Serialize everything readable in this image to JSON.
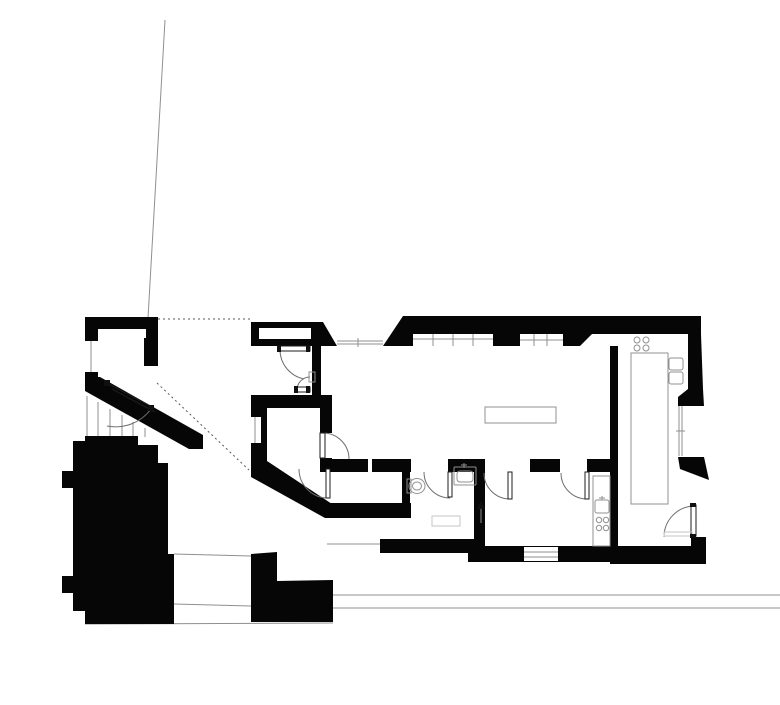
{
  "meta": {
    "document_type": "architectural-floor-plan",
    "drawing_style": "black-poche-plan",
    "title": "floor-plan"
  },
  "colors": {
    "background": "#ffffff",
    "wall": "#060606",
    "thin_line": "#8f8f8f",
    "dashed_line": "#5a5a5a",
    "arc_line": "#6e6e6e",
    "fixture_line": "#909090",
    "light_line": "#c6c6c6",
    "leaf_stroke": "#1c1c1c",
    "mark_fill": "#101010"
  },
  "canvas": {
    "width": 780,
    "height": 673
  },
  "plan": {
    "base_lines": [
      {
        "name": "site-boundary-line",
        "x1": 125,
        "y1": 4,
        "x2": 108,
        "y2": 302,
        "dash": false
      },
      {
        "name": "setback-dotted-line-top",
        "x1": 118,
        "y1": 303,
        "x2": 211,
        "y2": 303,
        "dash": true
      },
      {
        "name": "sightline-dotted-diagonal",
        "x1": 117,
        "y1": 367,
        "x2": 209,
        "y2": 454,
        "dash": true
      },
      {
        "name": "courtyard-line-top",
        "x1": 134,
        "y1": 538,
        "x2": 211,
        "y2": 540,
        "dash": false
      },
      {
        "name": "courtyard-line-mid",
        "x1": 134,
        "y1": 588,
        "x2": 211,
        "y2": 590,
        "dash": false
      },
      {
        "name": "site-bottom-line",
        "x1": 45,
        "y1": 608,
        "x2": 293,
        "y2": 607,
        "dash": false
      },
      {
        "name": "street-line-upper",
        "x1": 293,
        "y1": 579,
        "x2": 780,
        "y2": 579,
        "dash": false
      },
      {
        "name": "street-line-lower",
        "x1": 293,
        "y1": 592,
        "x2": 780,
        "y2": 592,
        "dash": false
      },
      {
        "name": "courtyard-edge-vertical",
        "x1": 117,
        "y1": 430,
        "x2": 117,
        "y2": 538,
        "dash": false
      },
      {
        "name": "stair-tread-1",
        "x1": 47,
        "y1": 380,
        "x2": 47,
        "y2": 420,
        "dash": false
      },
      {
        "name": "stair-tread-2",
        "x1": 58,
        "y1": 386,
        "x2": 58,
        "y2": 420,
        "dash": false
      },
      {
        "name": "stair-tread-3",
        "x1": 70,
        "y1": 393,
        "x2": 70,
        "y2": 420,
        "dash": false
      },
      {
        "name": "stair-tread-4",
        "x1": 82,
        "y1": 399,
        "x2": 82,
        "y2": 420,
        "dash": false
      },
      {
        "name": "stair-tread-5",
        "x1": 93,
        "y1": 406,
        "x2": 93,
        "y2": 420,
        "dash": false
      },
      {
        "name": "stair-tread-6",
        "x1": 105,
        "y1": 412,
        "x2": 105,
        "y2": 421,
        "dash": false
      }
    ],
    "wall_paths": [
      {
        "name": "entry-room-walls",
        "d": "M45,301 H118 V350 H104 V313 H58 V370 H45 Z"
      },
      {
        "name": "entry-diagonal-wall",
        "d": "M45,361 L60,361 L163,419 L163,433 L149,433 L45,375 Z"
      },
      {
        "name": "top-wall-left",
        "d": "M211,306 L283,306 L297,330 L211,330 Z"
      },
      {
        "name": "top-wall-mid-trapezoid",
        "d": "M363,300 H480 V330 H343 Z"
      },
      {
        "name": "top-wall-right",
        "d": "M480,300 H661 V318 H480 Z"
      },
      {
        "name": "top-wall-slant-piece",
        "d": "M523,318 H552 L540,330 H523 Z"
      },
      {
        "name": "right-wall-upper",
        "d": "M648,318 H661 L663,373 H648 Z"
      },
      {
        "name": "right-wall-bump",
        "d": "M648,373 H663 L664,390 H638 V381 Z"
      },
      {
        "name": "right-wall-pier",
        "d": "M638,441 L664,441 L669,464 L640,453 Z"
      },
      {
        "name": "kitchen-bottom-corner-wall",
        "d": "M570,530 H651 V521 H666 V548 H570 Z"
      },
      {
        "name": "bottom-wall-right-room",
        "d": "M428,530 H570 V546 H428 Z"
      },
      {
        "name": "right-room-west-column",
        "d": "M434,443 H445 V532 H434 Z"
      },
      {
        "name": "hall-band-seg-a",
        "d": "M280,443 H328 V456 H280 Z"
      },
      {
        "name": "hall-band-seg-b",
        "d": "M332,443 H371 V456 H332 Z"
      },
      {
        "name": "hall-band-seg-c",
        "d": "M408,443 H434 V456 H408 Z"
      },
      {
        "name": "hall-band-seg-d",
        "d": "M490,443 H520 V456 H490 Z"
      },
      {
        "name": "hall-band-seg-e",
        "d": "M547,443 H578 V456 H547 Z"
      },
      {
        "name": "vestibule-right-column",
        "d": "M272,330 H281 V392 H272 Z"
      },
      {
        "name": "vestibule-bottom-band",
        "d": "M211,379 H292 V392 H211 Z"
      },
      {
        "name": "bedroom-left-column",
        "d": "M211,392 H227 V449 H211 Z"
      },
      {
        "name": "bedroom-right-column-upper",
        "d": "M280,392 H292 V417 H280 Z"
      },
      {
        "name": "bedroom-right-column-lower",
        "d": "M280,442 H292 V456 H280 Z"
      },
      {
        "name": "bedroom-diagonal-wall",
        "d": "M211,445 L227,445 L292,488 L292,502 L285,502 L211,461 Z"
      },
      {
        "name": "storage-bottom-band",
        "d": "M285,487 H371 V502 H285 Z"
      },
      {
        "name": "bottom-band-mid",
        "d": "M340,523 H437 V537 H340 Z"
      },
      {
        "name": "wc-west-column",
        "d": "M362,455 H370 V488 H362 Z"
      },
      {
        "name": "kitchen-west-column",
        "d": "M570,330 H578 V548 H570 Z"
      },
      {
        "name": "existing-building-mass",
        "d": "M45,420 H98 V429 H118 V447 H128 V538 H134 V608 H45 V595 H33 V577 H22 V560 H33 V472 H22 V455 H33 V425 H45 Z"
      },
      {
        "name": "neighbor-building-mass",
        "d": "M211,538 L237,536 V565 L293,564 V606 H211 Z"
      }
    ],
    "white_openings": [
      {
        "name": "entry-wall-notch",
        "x": 99,
        "y": 313,
        "w": 7,
        "h": 9
      },
      {
        "name": "entry-left-window",
        "x": 45,
        "y": 325,
        "w": 13,
        "h": 31
      },
      {
        "name": "top-wall-window",
        "x": 219,
        "y": 312,
        "w": 52,
        "h": 11
      },
      {
        "name": "clerestory-window-band",
        "x": 373,
        "y": 318,
        "w": 80,
        "h": 12
      },
      {
        "name": "bedroom-west-window",
        "x": 211,
        "y": 401,
        "w": 10,
        "h": 26
      },
      {
        "name": "south-window",
        "x": 484,
        "y": 531,
        "w": 34,
        "h": 14
      }
    ],
    "detail_lines": [
      {
        "name": "window-glazing-left",
        "x1": 297,
        "y1": 325,
        "x2": 343,
        "y2": 325,
        "dash": false
      },
      {
        "name": "window-glazing-left-2",
        "x1": 297,
        "y1": 328,
        "x2": 343,
        "y2": 328,
        "dash": false
      },
      {
        "name": "window-mullion-tick",
        "x1": 318,
        "y1": 322,
        "x2": 318,
        "y2": 331,
        "dash": false
      },
      {
        "name": "clerestory-mullion-1",
        "x1": 393,
        "y1": 318,
        "x2": 393,
        "y2": 330,
        "dash": false
      },
      {
        "name": "clerestory-mullion-2",
        "x1": 413,
        "y1": 318,
        "x2": 413,
        "y2": 330,
        "dash": false
      },
      {
        "name": "clerestory-mullion-3",
        "x1": 433,
        "y1": 318,
        "x2": 433,
        "y2": 330,
        "dash": false
      },
      {
        "name": "clerestory-glazing",
        "x1": 373,
        "y1": 323,
        "x2": 453,
        "y2": 323,
        "dash": false
      },
      {
        "name": "band2-mullion-1",
        "x1": 494,
        "y1": 318,
        "x2": 494,
        "y2": 330,
        "dash": false
      },
      {
        "name": "band2-mullion-2",
        "x1": 507,
        "y1": 318,
        "x2": 507,
        "y2": 330,
        "dash": false
      },
      {
        "name": "band2-glazing",
        "x1": 480,
        "y1": 324,
        "x2": 523,
        "y2": 324,
        "dash": false
      },
      {
        "name": "entry-window-glazing",
        "x1": 51,
        "y1": 325,
        "x2": 51,
        "y2": 356,
        "dash": false
      },
      {
        "name": "bedroom-window-glazing",
        "x1": 215,
        "y1": 401,
        "x2": 215,
        "y2": 427,
        "dash": false
      },
      {
        "name": "kitchen-window-glazing-1",
        "x1": 639,
        "y1": 390,
        "x2": 639,
        "y2": 440,
        "dash": false
      },
      {
        "name": "kitchen-window-glazing-2",
        "x1": 642,
        "y1": 390,
        "x2": 642,
        "y2": 440,
        "dash": false
      },
      {
        "name": "kitchen-window-tick",
        "x1": 636,
        "y1": 415,
        "x2": 645,
        "y2": 415,
        "dash": false
      },
      {
        "name": "south-window-glazing-1",
        "x1": 484,
        "y1": 536,
        "x2": 518,
        "y2": 536,
        "dash": false
      },
      {
        "name": "south-window-glazing-2",
        "x1": 484,
        "y1": 541,
        "x2": 518,
        "y2": 541,
        "dash": false
      },
      {
        "name": "storage-floor-line",
        "x1": 287,
        "y1": 528,
        "x2": 340,
        "y2": 528,
        "dash": false
      },
      {
        "name": "wc-door-arrow-line",
        "x1": 441,
        "y1": 507,
        "x2": 441,
        "y2": 488,
        "dash": false
      },
      {
        "name": "wc-sink-faucet-v",
        "x1": 424,
        "y1": 447,
        "x2": 424,
        "y2": 452,
        "dash": false
      },
      {
        "name": "wc-sink-faucet-h",
        "x1": 421,
        "y1": 449,
        "x2": 427,
        "y2": 449,
        "dash": false
      },
      {
        "name": "counter-sink-faucet-v",
        "x1": 562,
        "y1": 480,
        "x2": 562,
        "y2": 484,
        "dash": false
      },
      {
        "name": "counter-sink-faucet-h",
        "x1": 559,
        "y1": 482,
        "x2": 565,
        "y2": 482,
        "dash": false
      }
    ],
    "arcs": [
      {
        "name": "vestibule-door-swing",
        "d": "M240,334 A30,30 0 0 0 264,363"
      },
      {
        "name": "vestibule-inner-door-swing",
        "d": "M257,374 A13,13 0 0 1 270,361"
      },
      {
        "name": "bedroom-door-swing",
        "d": "M283,417 A26,26 0 0 1 309,443"
      },
      {
        "name": "lower-hall-door-swing",
        "d": "M259,453 A29,29 0 0 0 288,482"
      },
      {
        "name": "wc-door-swing",
        "d": "M384,456 A26,26 0 0 0 410,482"
      },
      {
        "name": "south-room-door-swing-1",
        "d": "M444,457 A26,26 0 0 0 470,483"
      },
      {
        "name": "south-room-door-swing-2",
        "d": "M521,457 A26,26 0 0 0 547,483"
      },
      {
        "name": "kitchen-door-swing",
        "d": "M654,490 A31,31 0 0 0 624,521"
      },
      {
        "name": "entry-door-swing",
        "d": "M111,393 A44,44 0 0 1 67,410"
      }
    ],
    "stroke_paths": [
      {
        "name": "entry-door-leaf",
        "d": "M69,368 L112,391 M72,373 L115,396"
      }
    ],
    "door_leaves": [
      {
        "name": "vestibule-door-leaf",
        "x": 240,
        "y": 330,
        "w": 30,
        "h": 5
      },
      {
        "name": "vestibule-inner-door-leaf",
        "x": 257,
        "y": 371,
        "w": 13,
        "h": 5
      },
      {
        "name": "bedroom-door-leaf",
        "x": 280,
        "y": 417,
        "w": 5,
        "h": 25
      },
      {
        "name": "lower-hall-door-leaf",
        "x": 286,
        "y": 453,
        "w": 4,
        "h": 29
      },
      {
        "name": "wc-door-leaf",
        "x": 408,
        "y": 456,
        "w": 4,
        "h": 25
      },
      {
        "name": "south-room-door-leaf-1",
        "x": 468,
        "y": 456,
        "w": 4,
        "h": 27
      },
      {
        "name": "south-room-door-leaf-2",
        "x": 545,
        "y": 456,
        "w": 4,
        "h": 27
      },
      {
        "name": "kitchen-door-leaf",
        "x": 651,
        "y": 489,
        "w": 5,
        "h": 31
      }
    ],
    "fixture_rects": [
      {
        "name": "dining-table",
        "x": 445,
        "y": 391,
        "w": 71,
        "h": 16,
        "rx": 0,
        "light": false
      },
      {
        "name": "kitchen-island",
        "x": 591,
        "y": 337,
        "w": 37,
        "h": 151,
        "rx": 0,
        "light": false
      },
      {
        "name": "kitchen-sink-1",
        "x": 629,
        "y": 342,
        "w": 14,
        "h": 12,
        "rx": 2,
        "light": false
      },
      {
        "name": "kitchen-sink-2",
        "x": 629,
        "y": 356,
        "w": 14,
        "h": 12,
        "rx": 2,
        "light": false
      },
      {
        "name": "south-room-counter",
        "x": 553,
        "y": 460,
        "w": 17,
        "h": 70,
        "rx": 0,
        "light": false
      },
      {
        "name": "south-room-sink",
        "x": 555,
        "y": 484,
        "w": 14,
        "h": 13,
        "rx": 2,
        "light": false
      },
      {
        "name": "wc-sink-outer",
        "x": 414,
        "y": 451,
        "w": 22,
        "h": 18,
        "rx": 1,
        "light": false
      },
      {
        "name": "wc-sink-basin",
        "x": 417,
        "y": 455,
        "w": 16,
        "h": 11,
        "rx": 3,
        "light": false
      },
      {
        "name": "toilet-tank",
        "x": 367,
        "y": 463,
        "w": 4,
        "h": 14,
        "rx": 0,
        "light": false
      },
      {
        "name": "door-strike-plate",
        "x": 269,
        "y": 356,
        "w": 6,
        "h": 10,
        "rx": 0,
        "light": false
      },
      {
        "name": "wc-shower-mat",
        "x": 392,
        "y": 500,
        "w": 28,
        "h": 10,
        "rx": 0,
        "light": true
      },
      {
        "name": "kitchen-door-threshold",
        "x": 624,
        "y": 516,
        "w": 28,
        "h": 4,
        "rx": 0,
        "light": true
      }
    ],
    "fixture_circles": [
      {
        "name": "cooktop-burner-1",
        "cx": 597,
        "cy": 324,
        "r": 3
      },
      {
        "name": "cooktop-burner-2",
        "cx": 606,
        "cy": 324,
        "r": 3
      },
      {
        "name": "cooktop-burner-3",
        "cx": 597,
        "cy": 332,
        "r": 3
      },
      {
        "name": "cooktop-burner-4",
        "cx": 606,
        "cy": 332,
        "r": 3
      },
      {
        "name": "kitchenette-burner-1",
        "cx": 559,
        "cy": 504,
        "r": 2.7
      },
      {
        "name": "kitchenette-burner-2",
        "cx": 566,
        "cy": 504,
        "r": 2.7
      },
      {
        "name": "kitchenette-burner-3",
        "cx": 559,
        "cy": 512,
        "r": 2.7
      },
      {
        "name": "kitchenette-burner-4",
        "cx": 566,
        "cy": 512,
        "r": 2.7
      }
    ],
    "fixture_ellipses": [
      {
        "name": "toilet-bowl",
        "cx": 377,
        "cy": 470,
        "rx": 8,
        "ry": 7.5
      },
      {
        "name": "toilet-bowl-inner",
        "cx": 377,
        "cy": 470,
        "rx": 4.5,
        "ry": 4
      }
    ],
    "marks": [
      {
        "name": "entry-door-hinge-cap",
        "d": "M64,364 h6 v6 h-6 Z"
      },
      {
        "name": "entry-door-latch-cap",
        "d": "M108,389 h6 v6 h-6 Z"
      },
      {
        "name": "vestibule-door-cap-1",
        "d": "M237,329 h4 v7 h-4 Z"
      },
      {
        "name": "vestibule-door-cap-2",
        "d": "M266,329 h4 v7 h-4 Z"
      },
      {
        "name": "vestibule-inner-door-cap-1",
        "d": "M254,370 h4 v7 h-4 Z"
      },
      {
        "name": "vestibule-inner-door-cap-2",
        "d": "M266,370 h4 v7 h-4 Z"
      },
      {
        "name": "kitchen-door-cap-1",
        "d": "M650,487 h6 v4 h-6 Z"
      },
      {
        "name": "kitchen-door-cap-2",
        "d": "M650,518 h6 v4 h-6 Z"
      },
      {
        "name": "wc-door-arrowhead",
        "d": "M437,493 L441,485 L445,493 Z"
      }
    ]
  }
}
